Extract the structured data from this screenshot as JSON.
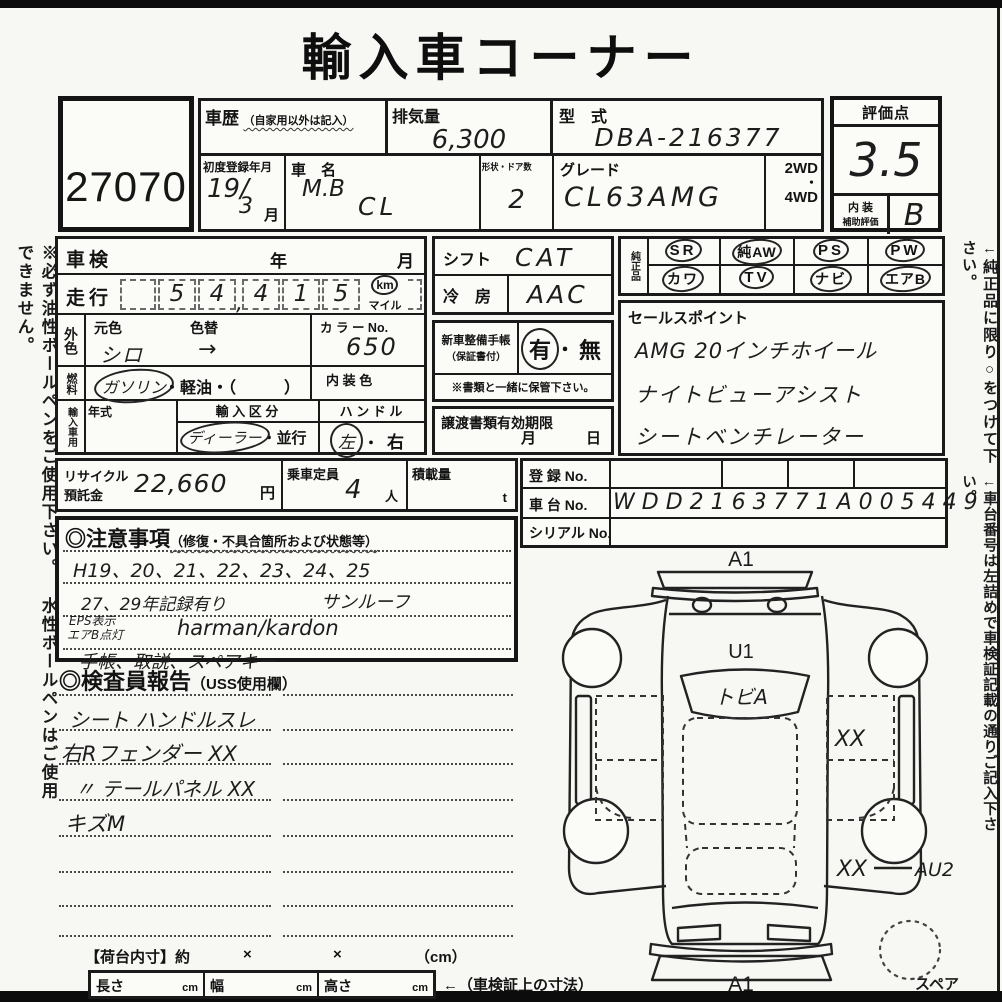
{
  "page": {
    "title": "輸入車コーナー",
    "lot_no": "27070"
  },
  "margin_notes": {
    "left": "※必ず油性ボールペンをご使用下さい。 水性ボールペンはご使用できません。",
    "right_top": "←純正品に限り○をつけて下さい。",
    "right_bottom": "←車台番号は左詰めで車検証記載の通りご記入下さい。"
  },
  "top": {
    "history_label": "車歴",
    "history_note": "（自家用以外は記入）",
    "displacement_label": "排気量",
    "displacement": "6,300",
    "model_code_label": "型　式",
    "model_code": "DBA-216377",
    "first_reg_label": "初度登録年月",
    "first_reg_1": "19/",
    "first_reg_2": "3",
    "first_reg_suffix": "月",
    "name_label": "車　名",
    "name_line1": "M.B",
    "name_line2": "CL",
    "shape_label": "形状・ドア数",
    "doors": "2",
    "grade_label": "グレード",
    "grade": "CL63AMG",
    "drive_2wd": "2WD",
    "drive_dot": "・",
    "drive_4wd": "4WD"
  },
  "score": {
    "label": "評価点",
    "value": "3.5",
    "interior_label_1": "内 装",
    "interior_label_2": "補助評価",
    "interior_value": "B"
  },
  "inspection": {
    "label": "車検",
    "year": "年",
    "month": "月"
  },
  "mileage": {
    "label": "走行",
    "digits": [
      "5",
      "4",
      "4",
      "1",
      "5"
    ],
    "comma": ",",
    "unit_km": "km",
    "unit_mile": "マイル"
  },
  "color": {
    "label": "外色",
    "base_label": "元色",
    "base": "シロ",
    "repaint_label": "色替",
    "repaint": "→",
    "no_label": "カ ラ ー No.",
    "no": "650"
  },
  "fuel": {
    "label": "燃料",
    "gasoline": "ガソリン",
    "rest": "・軽油・（　　　）",
    "interior_color_label": "内 装 色"
  },
  "import": {
    "label": "輸入車用",
    "year_label": "年式",
    "class_label": "輸 入 区 分",
    "dealer": "ディーラー",
    "dot": "・",
    "parallel": "並行",
    "handle_label": "ハ ン ド ル",
    "left": "左",
    "handle_dot": "・",
    "right": "右"
  },
  "shift": {
    "label": "シフト",
    "value": "CAT",
    "ac_label": "冷　房",
    "ac_value": "AAC"
  },
  "book": {
    "label_1": "新車整備手帳",
    "label_2": "（保証書付）",
    "yes": "有",
    "dot": "・",
    "no": "無",
    "note": "※書類と一緒に保管下さい。"
  },
  "transfer": {
    "label": "譲渡書類有効期限",
    "month": "月",
    "day": "日"
  },
  "oem": {
    "label": "純正品",
    "row1": [
      "SR",
      "純AW",
      "PS",
      "PW"
    ],
    "row2": [
      "カワ",
      "TV",
      "ナビ",
      "エアB"
    ]
  },
  "sales": {
    "label": "セールスポイント",
    "lines": [
      "AMG 20インチホイール",
      "ナイトビューアシスト",
      "シートベンチレーター"
    ]
  },
  "recycle": {
    "label_1": "リサイクル",
    "label_2": "預託金",
    "amount": "22,660",
    "yen": "円",
    "capacity_label": "乗車定員",
    "capacity": "4",
    "unit_person": "人",
    "load_label": "積載量",
    "unit_t": "t"
  },
  "registration": {
    "reg_label": "登 録 No.",
    "chassis_label": "車 台 No.",
    "chassis": "WDD2163771A005449",
    "serial_label": "シリアル No."
  },
  "notes": {
    "header": "◎注意事項",
    "header_sub": "（修復・不具合箇所および状態等）",
    "line1": "H19、20、21、22、23、24、25",
    "line2a": "27、29年記録有り",
    "line2b": "サンルーフ",
    "line3a": "EPS表示",
    "line3b": "エアB点灯",
    "line3c": "harman/kardon",
    "line4": "手帳、取説、スペアキー"
  },
  "inspector": {
    "header": "◎検査員報告",
    "header_sub": "（USS使用欄）",
    "line1": "シート ハンドルスレ",
    "line2": "右Rフェンダー XX",
    "line3": "〃 テールパネル XX",
    "line4": "キズM"
  },
  "diagram": {
    "front": "A1",
    "hood": "U1",
    "windshield": "トビA",
    "front_door": "XX",
    "rear_quarter": "XX",
    "rear_code": "AU2",
    "rear": "A1",
    "spare": "スペア"
  },
  "bed": {
    "label": "【荷台内寸】約",
    "x1": "×",
    "x2": "×",
    "cm_paren": "（cm）",
    "length": "長さ",
    "width": "幅",
    "height": "高さ",
    "cm1": "cm",
    "cm2": "cm",
    "cm3": "cm",
    "arrow": "←（車検証上の寸法）"
  }
}
